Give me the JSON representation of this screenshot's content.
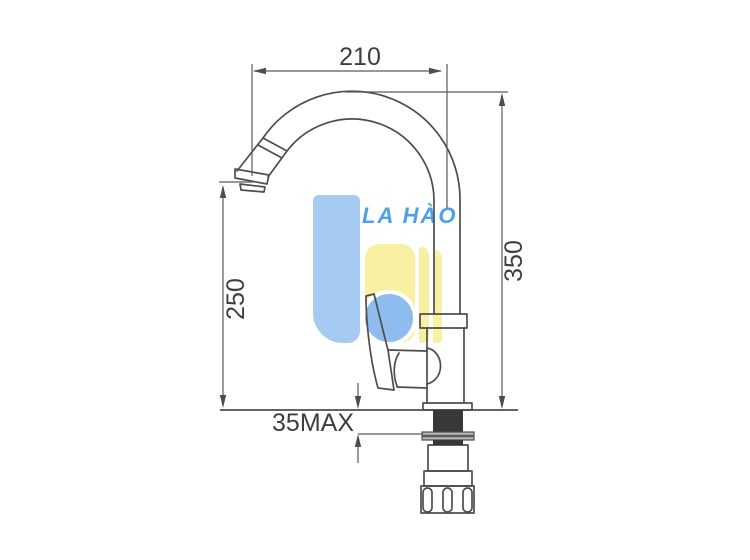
{
  "page": {
    "background_color": "#ffffff",
    "content": "technical dimension drawing of a single-handle gooseneck kitchen faucet, side view"
  },
  "watermark": {
    "brand_text": "LA HÀO",
    "brand_text_color": "#4fa0e6",
    "shape_blue": "#a6cbf3",
    "circle_blue": "#8fbcee",
    "shape_yellow": "#f8f1a1"
  },
  "dimensions": {
    "spout_reach": "210",
    "overall_height": "350",
    "spout_outlet_height": "250",
    "max_deck_thickness": "35MAX"
  },
  "drawing": {
    "outline_color": "#4d4d4d",
    "dimension_line_color": "#5a5a5a",
    "dimension_text_color": "#3e3e3e",
    "mounting_shank_color": "#383838",
    "washer_color": "#b8b8b8"
  }
}
